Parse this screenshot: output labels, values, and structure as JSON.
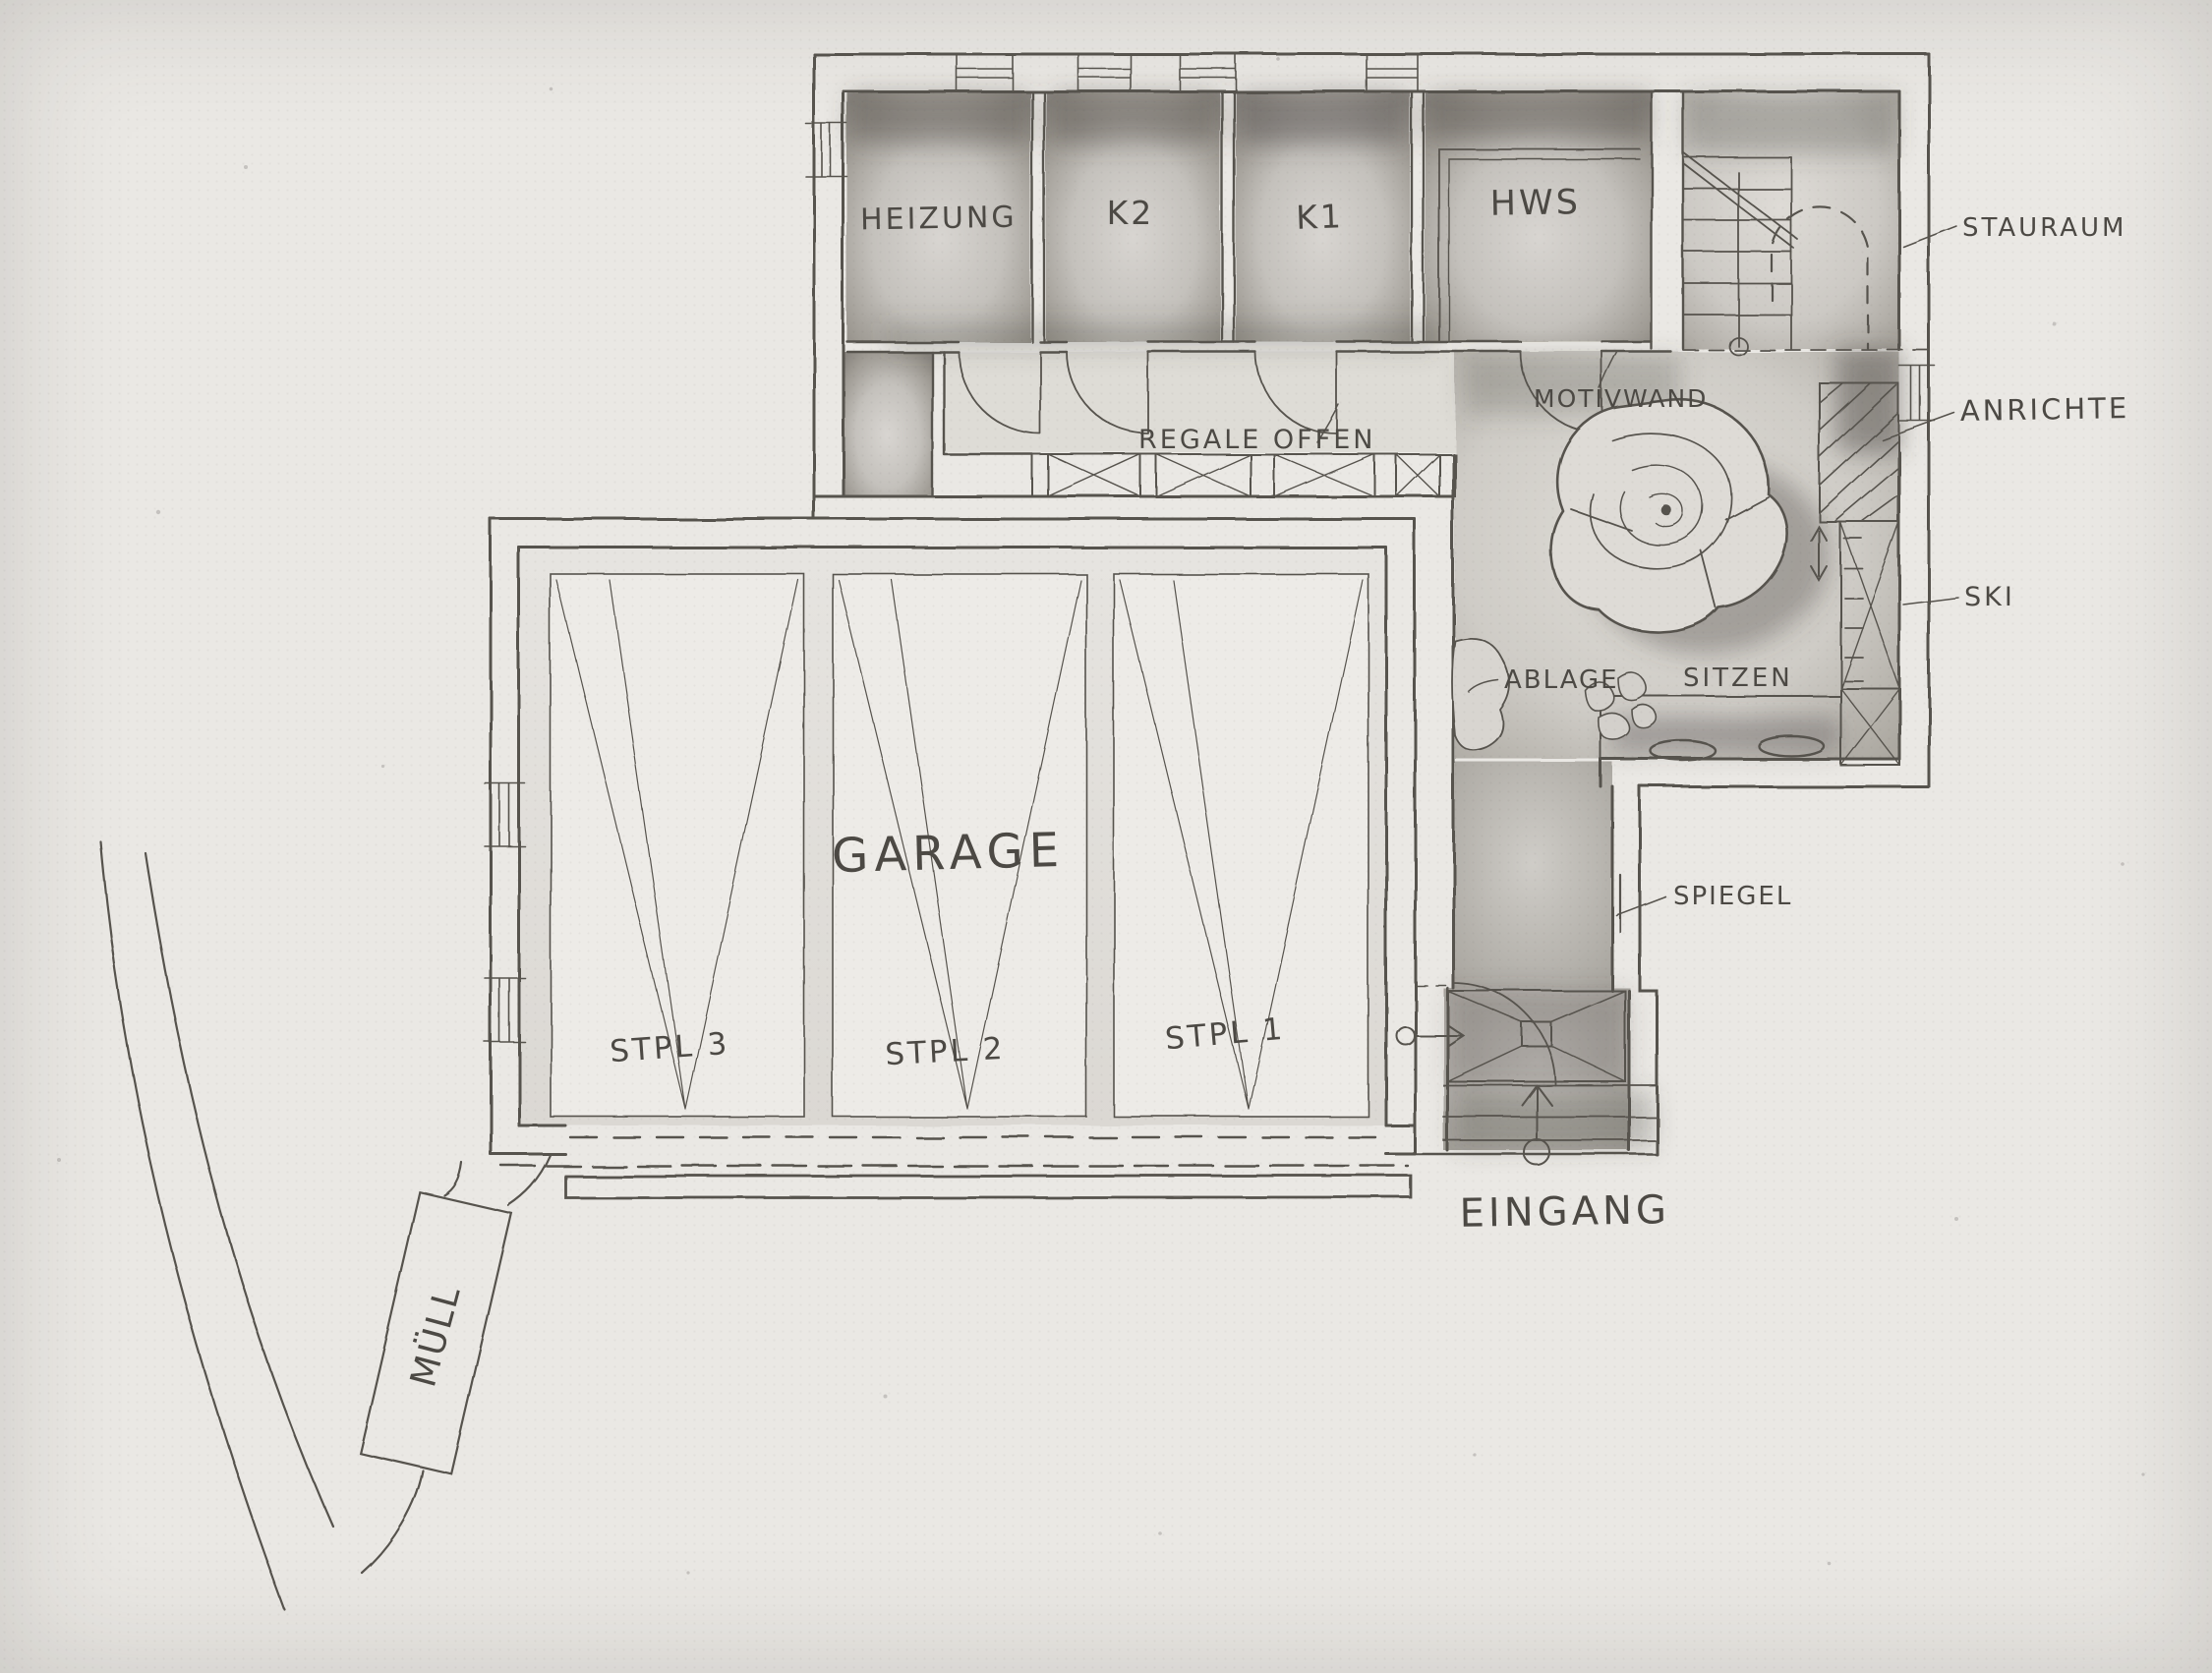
{
  "plan": {
    "title": "Hand-drawn floor plan — garage and entrance level",
    "rooms": [
      {
        "id": "heizung",
        "label": "HEIZUNG"
      },
      {
        "id": "k2",
        "label": "K2"
      },
      {
        "id": "k1",
        "label": "K1"
      },
      {
        "id": "hws",
        "label": "HWS"
      },
      {
        "id": "garage",
        "label": "GARAGE"
      }
    ],
    "parking_stalls": [
      {
        "id": "stpl3",
        "label": "STPL 3"
      },
      {
        "id": "stpl2",
        "label": "STPL 2"
      },
      {
        "id": "stpl1",
        "label": "STPL 1"
      }
    ],
    "annotations": [
      {
        "id": "stauraum",
        "label": "STAURAUM"
      },
      {
        "id": "anrichte",
        "label": "ANRICHTE"
      },
      {
        "id": "ski",
        "label": "SKI"
      },
      {
        "id": "motivwand",
        "label": "MOTIVWAND"
      },
      {
        "id": "regale-offen",
        "label": "REGALE OFFEN"
      },
      {
        "id": "ablage",
        "label": "ABLAGE"
      },
      {
        "id": "sitzen",
        "label": "SITZEN"
      },
      {
        "id": "spiegel",
        "label": "SPIEGEL"
      },
      {
        "id": "eingang",
        "label": "EINGANG"
      },
      {
        "id": "muell",
        "label": "MÜLL"
      }
    ],
    "colors": {
      "paper": "#eae8e4",
      "pencil": "#57534d",
      "shade_dark": "#8a8680",
      "shade_light": "#d6d3cf"
    }
  }
}
